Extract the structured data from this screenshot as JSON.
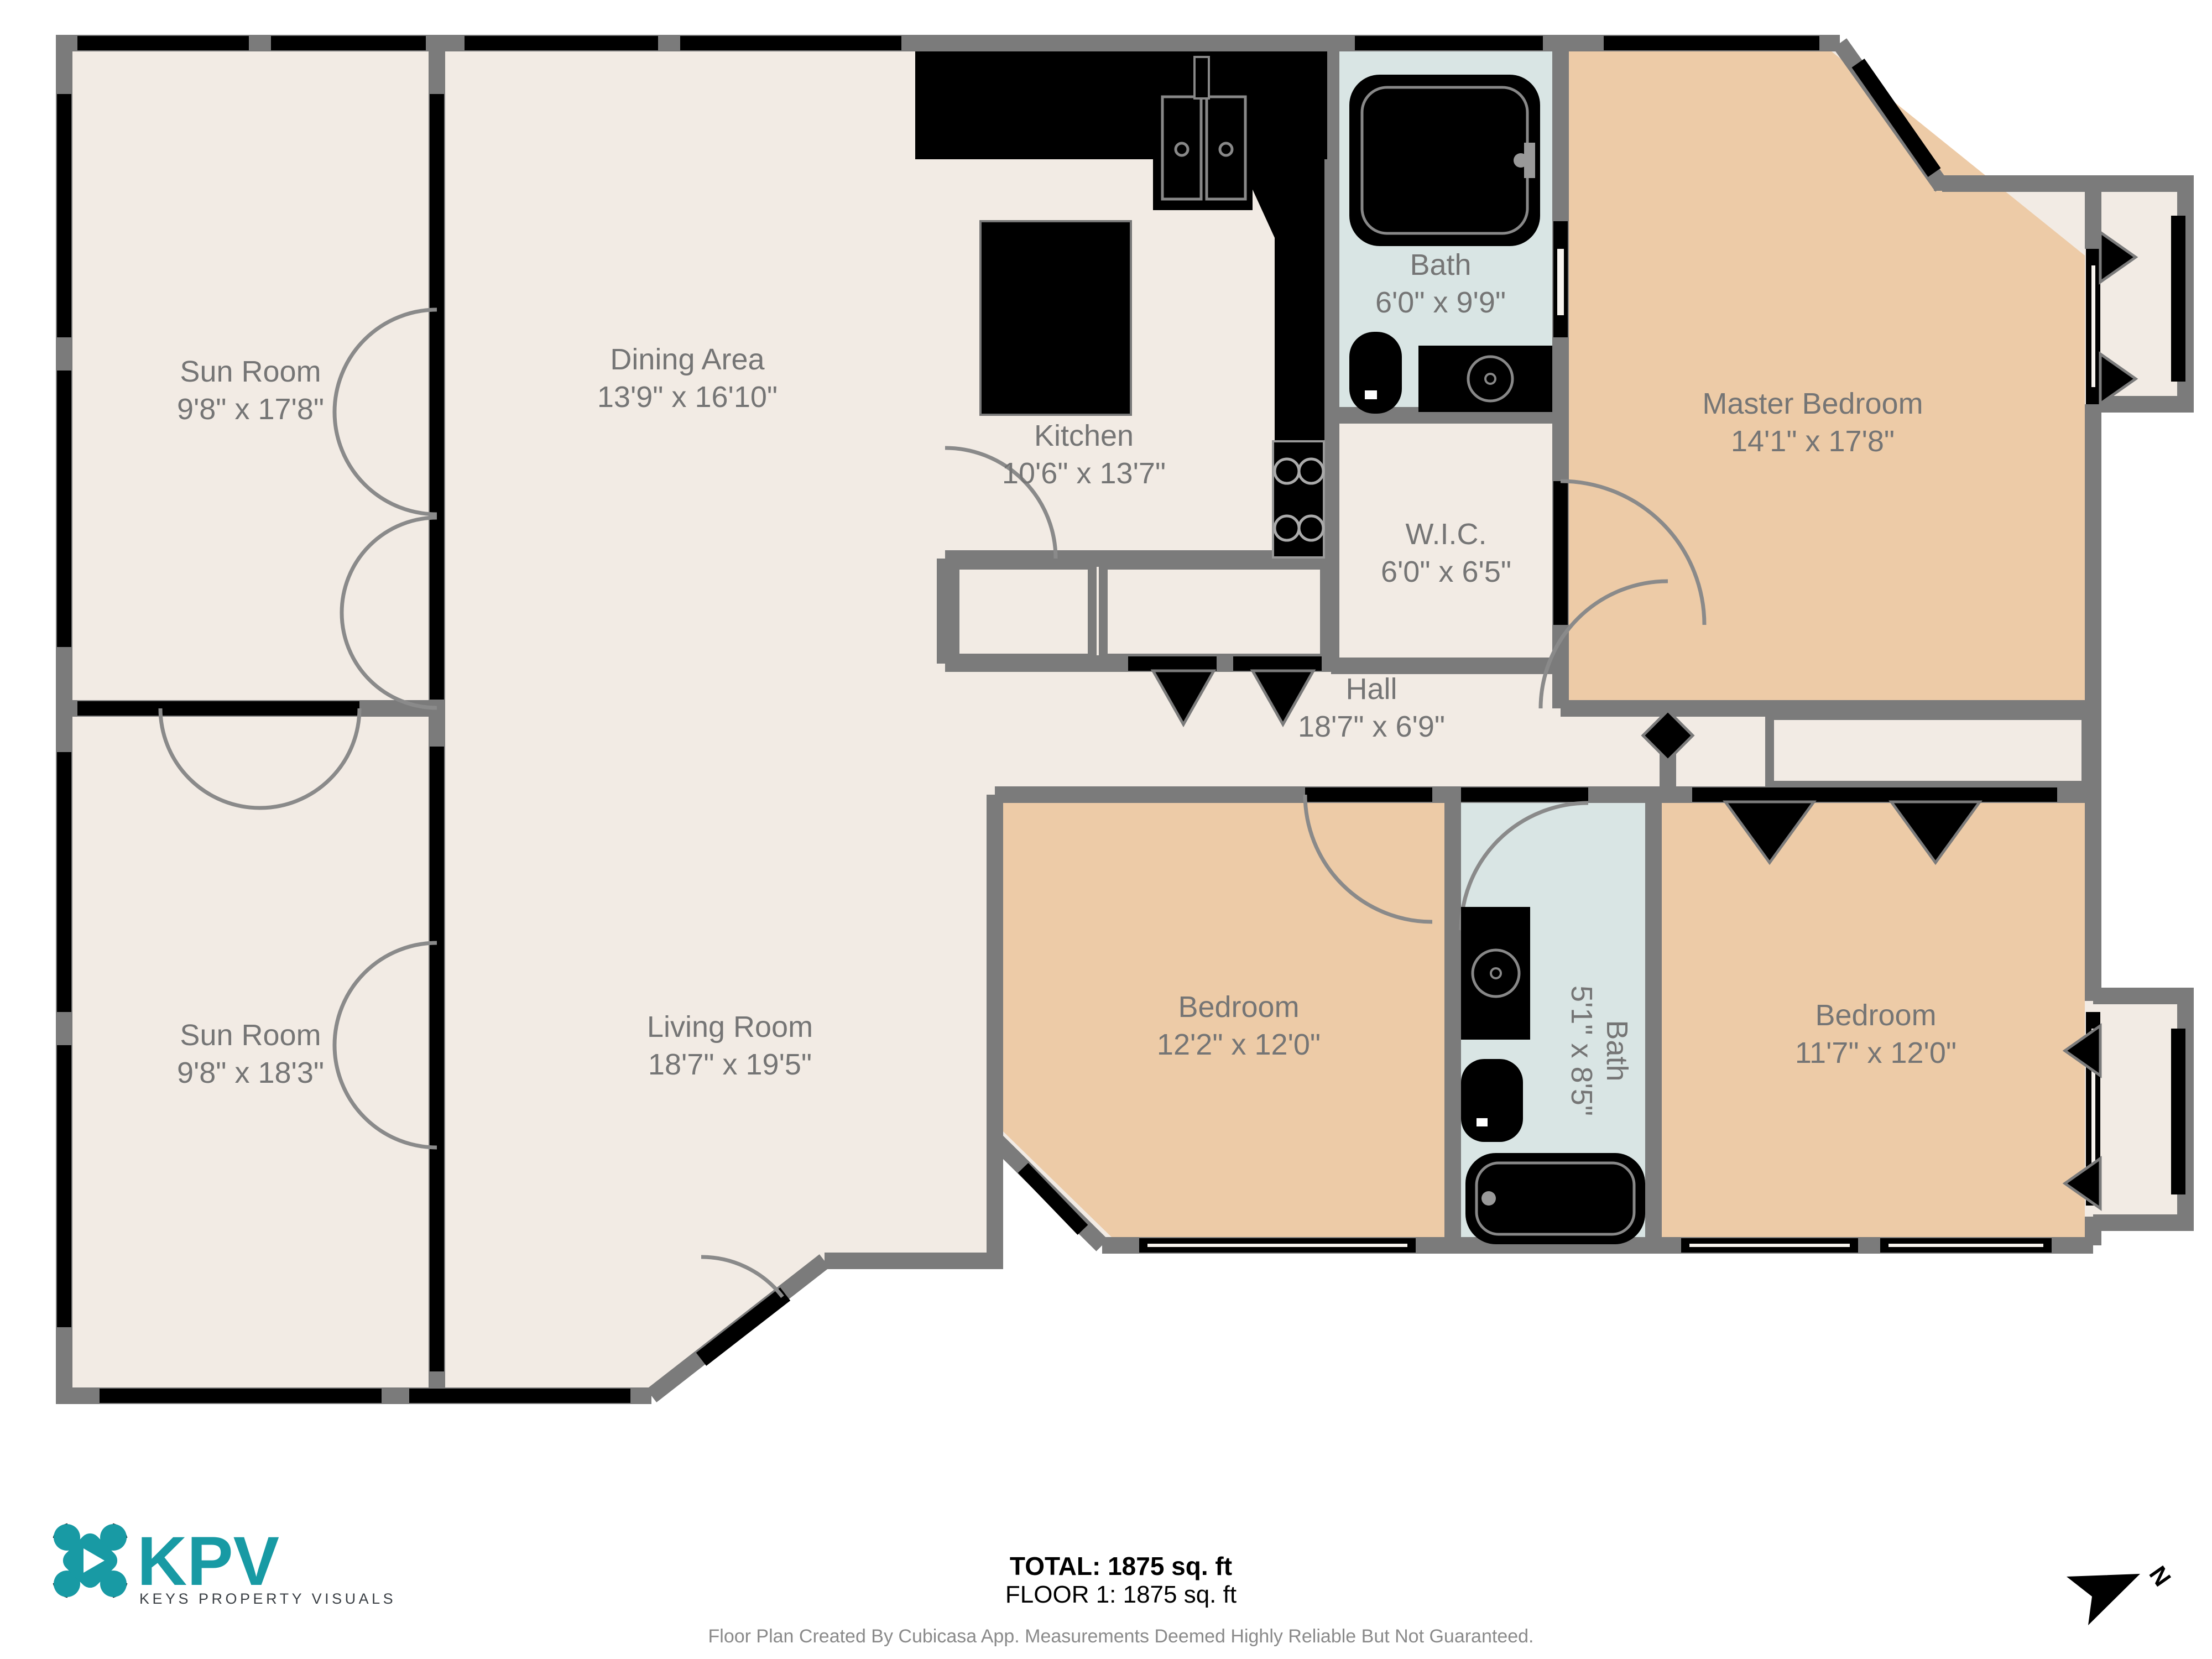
{
  "plan": {
    "rooms": {
      "sunroom_top": {
        "name": "Sun Room",
        "dims": "9'8\" x 17'8\""
      },
      "dining": {
        "name": "Dining Area",
        "dims": "13'9\" x 16'10\""
      },
      "kitchen": {
        "name": "Kitchen",
        "dims": "10'6\" x 13'7\""
      },
      "bath_top": {
        "name": "Bath",
        "dims": "6'0\" x 9'9\""
      },
      "master": {
        "name": "Master Bedroom",
        "dims": "14'1\" x 17'8\""
      },
      "wic": {
        "name": "W.I.C.",
        "dims": "6'0\" x 6'5\""
      },
      "hall": {
        "name": "Hall",
        "dims": "18'7\" x 6'9\""
      },
      "bedroom_left": {
        "name": "Bedroom",
        "dims": "12'2\" x 12'0\""
      },
      "bath_mid": {
        "name": "Bath",
        "dims": "5'1\" x 8'5\""
      },
      "bedroom_right": {
        "name": "Bedroom",
        "dims": "11'7\" x 12'0\""
      },
      "sunroom_bottom": {
        "name": "Sun Room",
        "dims": "9'8\" x 18'3\""
      },
      "living": {
        "name": "Living Room",
        "dims": "18'7\" x 19'5\""
      }
    },
    "colors": {
      "floor_cream": "#f2ebe4",
      "bedroom_peach": "#edcba7",
      "bath_blue": "#d9e5e4",
      "wall_gray": "#7b7b7b",
      "label_gray": "#757575",
      "brand_teal": "#189aa4"
    },
    "compass_label": "N"
  },
  "footer": {
    "total": "TOTAL: 1875 sq. ft",
    "floor": "FLOOR 1: 1875 sq. ft",
    "disclaimer": "Floor Plan Created By Cubicasa App. Measurements Deemed Highly Reliable But Not Guaranteed."
  },
  "logo": {
    "brand": "KPV",
    "tagline": "KEYS PROPERTY VISUALS"
  }
}
